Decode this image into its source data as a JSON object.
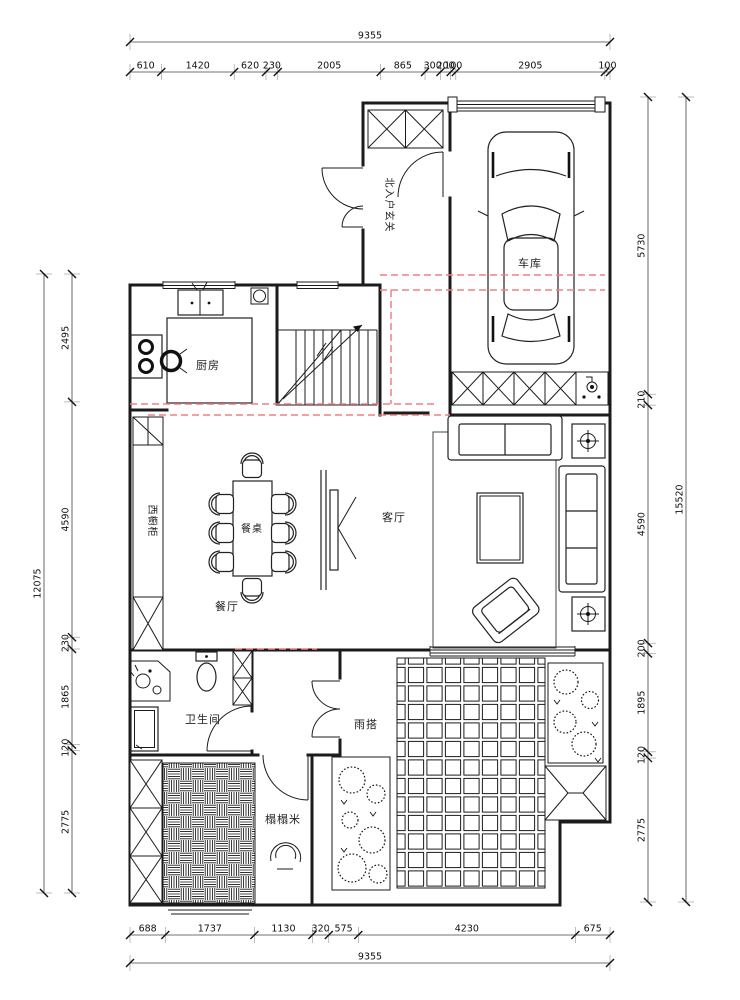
{
  "meta": {
    "background": "#ffffff",
    "wall_color": "#1b1b1b",
    "dimension_color": "#111111",
    "highlight_dash_color": "#f28080"
  },
  "plan": {
    "labels": {
      "garage": "车库",
      "north_entry_foyer": "北入户玄关",
      "kitchen": "厨房",
      "west_cabinet": "西橱柜",
      "dining_table": "餐桌",
      "dining_room": "餐厅",
      "living_room": "客厅",
      "bathroom": "卫生间",
      "rain_canopy": "雨搭",
      "tatami": "榻榻米"
    }
  },
  "dimensions": {
    "top": {
      "total": "9355",
      "segments": [
        "610",
        "1420",
        "620",
        "230",
        "2005",
        "865",
        "300",
        "200",
        "100",
        "2905",
        "100"
      ]
    },
    "bottom": {
      "total": "9355",
      "segments": [
        "688",
        "1737",
        "1130",
        "320",
        "575",
        "4230",
        "675"
      ]
    },
    "left": {
      "total": "12075",
      "segments": [
        "2495",
        "4590",
        "230",
        "1865",
        "120",
        "2775"
      ]
    },
    "right": {
      "total": "15520",
      "segments": [
        "5730",
        "210",
        "4590",
        "200",
        "1895",
        "120",
        "2775"
      ]
    }
  }
}
